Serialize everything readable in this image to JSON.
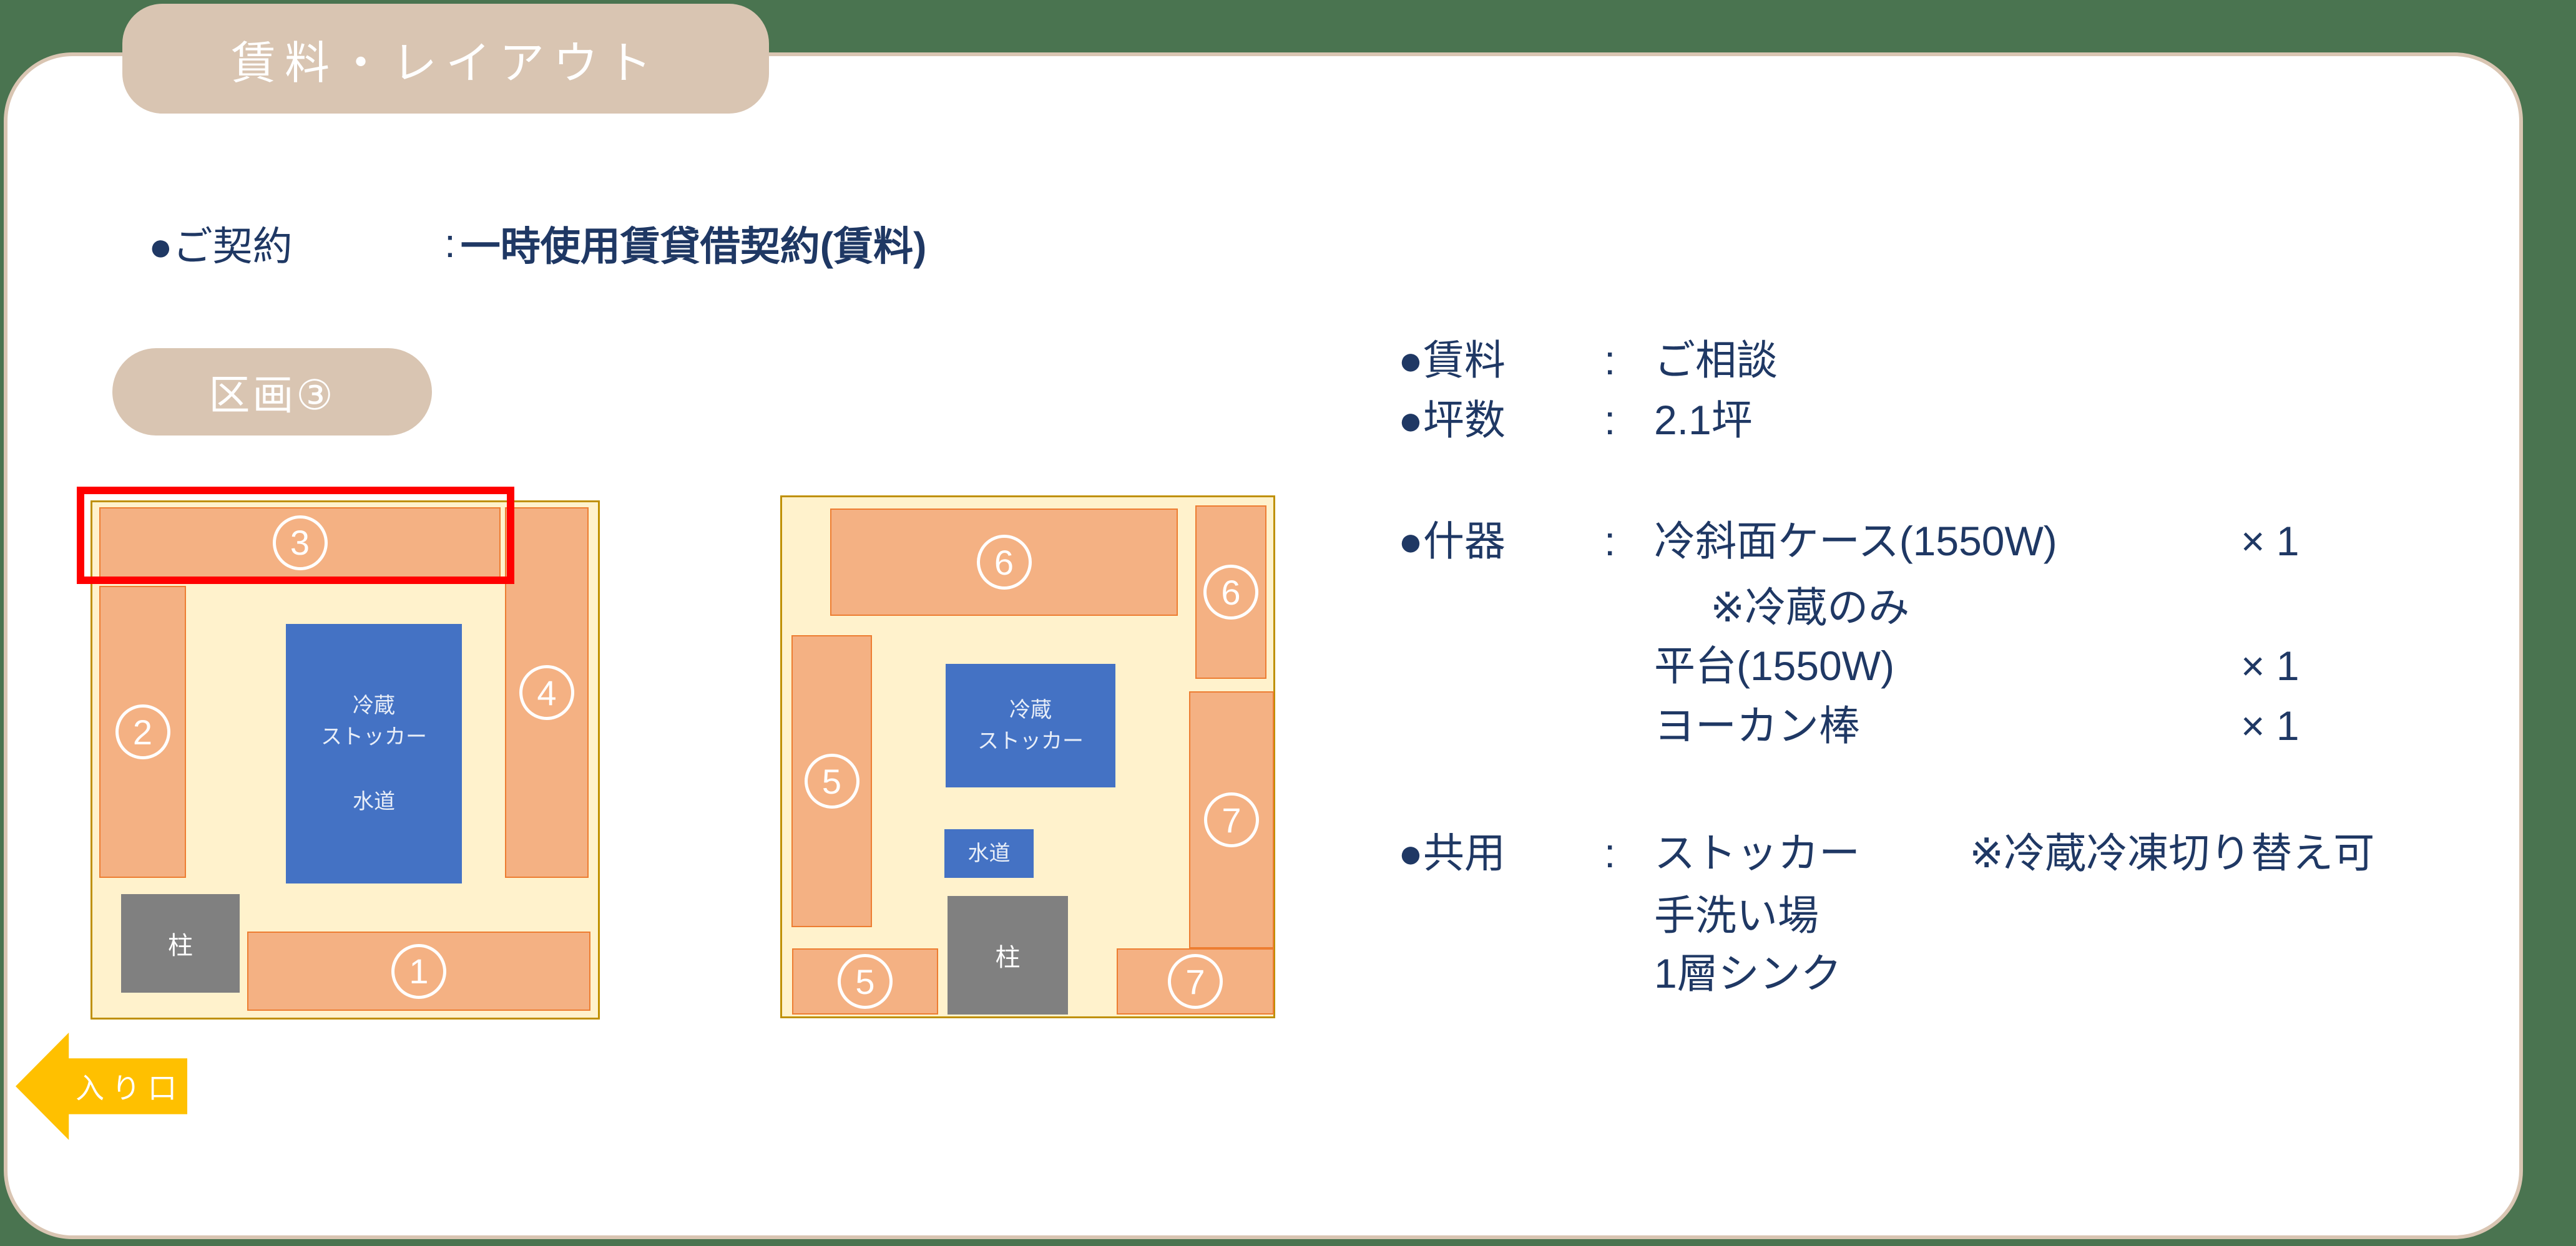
{
  "title_tab": {
    "label": "賃料・レイアウト"
  },
  "contract_line": {
    "label": "●ご契約",
    "colon": ":",
    "value": "一時使用賃貸借契約(賃料)"
  },
  "section_badge": {
    "label": "区画③"
  },
  "plan_left": {
    "unit1": "1",
    "unit2": "2",
    "unit3": "3",
    "unit4": "4",
    "stocker_line1": "冷蔵",
    "stocker_line2": "ストッカー",
    "water": "水道",
    "pillar": "柱"
  },
  "plan_right": {
    "unit6_top": "6",
    "unit6_side": "6",
    "unit5_side": "5",
    "unit7_side": "7",
    "unit5_bottom": "5",
    "unit7_bottom": "7",
    "stocker_line1": "冷蔵",
    "stocker_line2": "ストッカー",
    "water": "水道",
    "pillar": "柱"
  },
  "details": {
    "rent_label": "●賃料",
    "rent_colon": ":",
    "rent_value": "ご相談",
    "area_label": "●坪数",
    "area_colon": ":",
    "area_value": "2.1坪",
    "fixtures_label": "●什器",
    "fixtures_colon": ":",
    "fixtures_item1": "冷斜面ケース(1550W)",
    "fixtures_item1_qty": "× 1",
    "fixtures_note": "※冷蔵のみ",
    "fixtures_item2": "平台(1550W)",
    "fixtures_item2_qty": "× 1",
    "fixtures_item3": "ヨーカン棒",
    "fixtures_item3_qty": "× 1",
    "shared_label": "●共用",
    "shared_colon": ":",
    "shared_item1": "ストッカー",
    "shared_note": "※冷蔵冷凍切り替え可",
    "shared_item2": "手洗い場",
    "shared_item3": "1層シンク"
  },
  "entrance": {
    "label": "入り口"
  },
  "colors": {
    "background_green": "#4A7450",
    "tab_tan": "#D9C5B2",
    "text_navy": "#1F3864",
    "unit_orange_fill": "#F4B183",
    "unit_orange_border": "#ED7D31",
    "plan_cream": "#FFF2CC",
    "plan_gold_border": "#BF9000",
    "equipment_blue": "#4472C4",
    "pillar_gray": "#808080",
    "highlight_red": "#FF0000",
    "entrance_amber": "#FFC000"
  }
}
